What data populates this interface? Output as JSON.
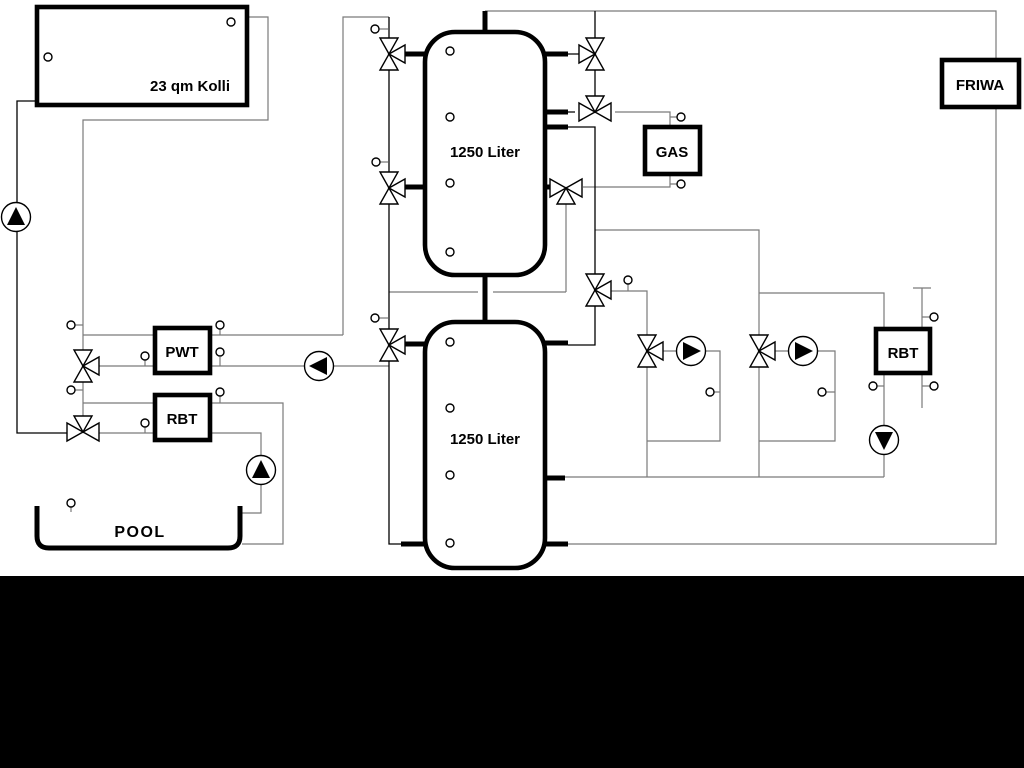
{
  "diagram": {
    "title_hint": "hydraulic scheme with solar collector, buffer tanks, gas boiler, pool",
    "labels": {
      "collector": "23 qm Kolli",
      "tank1": "1250 Liter",
      "tank2": "1250 Liter",
      "pwt": "PWT",
      "rbt_left": "RBT",
      "rbt_right": "RBT",
      "gas": "GAS",
      "friwa": "FRIWA",
      "pool": "POOL"
    },
    "colors": {
      "line_gray": "#7a7a7a",
      "line_black": "#000000",
      "background": "#ffffff",
      "footer_band": "#000000"
    },
    "components": {
      "pumps": 6,
      "three_way_valves": 11,
      "temperature_sensors": 24,
      "buffer_tanks": 2
    }
  }
}
